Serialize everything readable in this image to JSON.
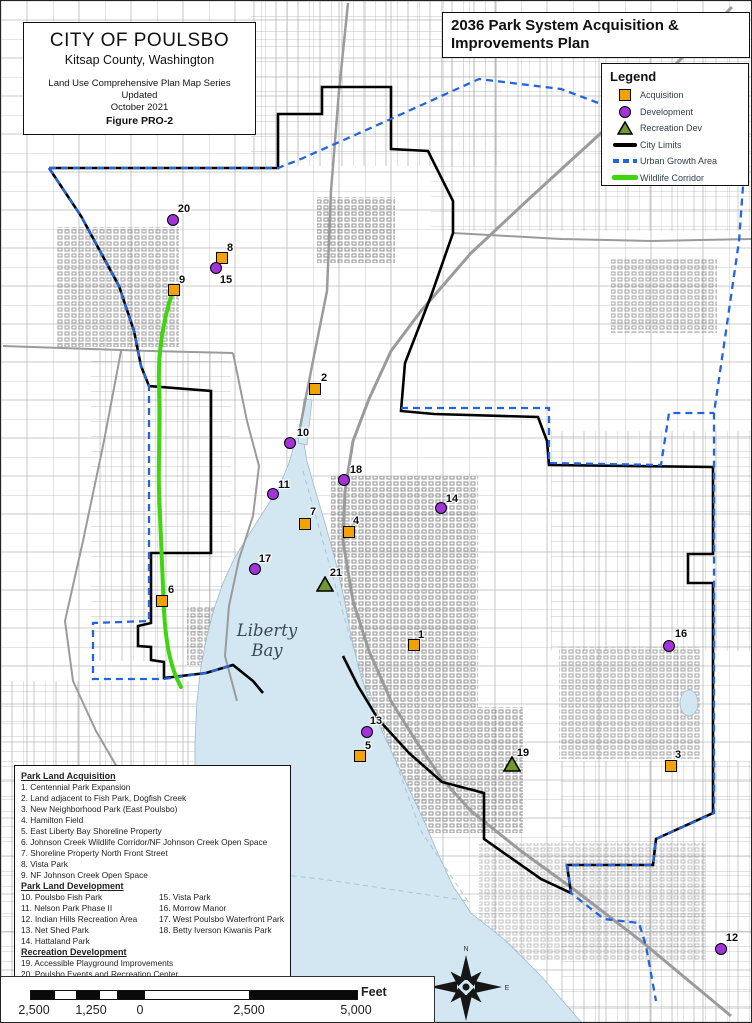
{
  "map_title_box": {
    "city": "CITY OF POULSBO",
    "county": "Kitsap County, Washington",
    "series": "Land Use Comprehensive Plan Map Series",
    "updated": "Updated",
    "date": "October 2021",
    "figure": "Figure PRO-2"
  },
  "plan_title": "2036 Park System Acquisition & Improvements Plan",
  "legend": {
    "title": "Legend",
    "items": [
      {
        "label": "Acquisition",
        "symbol": "acquisition-square",
        "color": "#F3A204"
      },
      {
        "label": "Development",
        "symbol": "development-circle",
        "color": "#A233D6"
      },
      {
        "label": "Recreation Dev",
        "symbol": "recreation-triangle",
        "color": "#6F9A2D"
      },
      {
        "label": "City Limits",
        "symbol": "city-limits-line",
        "color": "#000000"
      },
      {
        "label": "Urban Growth Area",
        "symbol": "uga-dashed-line",
        "color": "#2465DE"
      },
      {
        "label": "Wildlife Corridor",
        "symbol": "wildlife-line",
        "color": "#3FD60F"
      }
    ]
  },
  "park_list": {
    "sections": [
      {
        "title": "Park Land Acquisition",
        "items": [
          "1.  Centennial Park Expansion",
          "2.  Land adjacent to Fish Park, Dogfish Creek",
          "3.  New Neighborhood Park (East Poulsbo)",
          "4.  Hamilton Field",
          "5.  East Liberty Bay Shoreline Property",
          "6.  Johnson Creek Wildlife Corridor/NF Johnson Creek Open Space",
          "7.  Shoreline Property North Front Street",
          "8.  Vista Park",
          "9.  NF Johnson Creek Open Space"
        ]
      },
      {
        "title": "Park Land Development",
        "columns": [
          [
            "10. Poulsbo Fish Park",
            "11. Nelson Park Phase II",
            "12. Indian Hills Recreation Area",
            "13. Net Shed Park",
            "14. Hattaland Park"
          ],
          [
            "15. Vista Park",
            "16. Morrow Manor",
            "17. West Poulsbo Waterfront Park",
            "18. Betty Iverson Kiwanis Park"
          ]
        ]
      },
      {
        "title": "Recreation Development",
        "items": [
          "19. Accessible Playground Improvements",
          "20. Poulsbo Events and Recreation Center",
          "21. Poulsbo Recreation Center"
        ]
      }
    ]
  },
  "map_labels": {
    "water_body": "Liberty Bay"
  },
  "markers": [
    {
      "n": "1",
      "type": "acquisition",
      "x": 413,
      "y": 644,
      "dx": 7,
      "dy": -10
    },
    {
      "n": "2",
      "type": "acquisition",
      "x": 314,
      "y": 388,
      "dx": 9,
      "dy": -11
    },
    {
      "n": "3",
      "type": "acquisition",
      "x": 670,
      "y": 765,
      "dx": 7,
      "dy": -11
    },
    {
      "n": "4",
      "type": "acquisition",
      "x": 348,
      "y": 531,
      "dx": 7,
      "dy": -11
    },
    {
      "n": "5",
      "type": "acquisition",
      "x": 359,
      "y": 755,
      "dx": 8,
      "dy": -10
    },
    {
      "n": "6",
      "type": "acquisition",
      "x": 161,
      "y": 600,
      "dx": 9,
      "dy": -11
    },
    {
      "n": "7",
      "type": "acquisition",
      "x": 304,
      "y": 523,
      "dx": 8,
      "dy": -12
    },
    {
      "n": "8",
      "type": "acquisition",
      "x": 221,
      "y": 257,
      "dx": 8,
      "dy": -10
    },
    {
      "n": "9",
      "type": "acquisition",
      "x": 173,
      "y": 289,
      "dx": 8,
      "dy": -10
    },
    {
      "n": "10",
      "type": "development",
      "x": 289,
      "y": 442,
      "dx": 13,
      "dy": -10
    },
    {
      "n": "11",
      "type": "development",
      "x": 272,
      "y": 493,
      "dx": 11,
      "dy": -9
    },
    {
      "n": "12",
      "type": "development",
      "x": 720,
      "y": 948,
      "dx": 11,
      "dy": -11
    },
    {
      "n": "13",
      "type": "development",
      "x": 366,
      "y": 731,
      "dx": 9,
      "dy": -11
    },
    {
      "n": "14",
      "type": "development",
      "x": 440,
      "y": 507,
      "dx": 11,
      "dy": -9
    },
    {
      "n": "15",
      "type": "development",
      "x": 215,
      "y": 267,
      "dx": 10,
      "dy": 12
    },
    {
      "n": "16",
      "type": "development",
      "x": 668,
      "y": 645,
      "dx": 12,
      "dy": -12
    },
    {
      "n": "17",
      "type": "development",
      "x": 254,
      "y": 568,
      "dx": 10,
      "dy": -10
    },
    {
      "n": "18",
      "type": "development",
      "x": 343,
      "y": 479,
      "dx": 12,
      "dy": -10
    },
    {
      "n": "19",
      "type": "recreation",
      "x": 511,
      "y": 763,
      "dx": 11,
      "dy": -11
    },
    {
      "n": "20",
      "type": "development",
      "x": 172,
      "y": 219,
      "dx": 11,
      "dy": -11
    },
    {
      "n": "21",
      "type": "recreation",
      "x": 324,
      "y": 583,
      "dx": 11,
      "dy": -11
    }
  ],
  "scale_bar": {
    "labels": [
      "2,500",
      "1,250",
      "0",
      "2,500",
      "5,000"
    ],
    "unit": "Feet"
  },
  "compass": {
    "n": "N",
    "e": "E",
    "s": "S",
    "w": "W"
  },
  "colors": {
    "water": "#d3e7f3",
    "acquisition": "#F3A204",
    "development": "#A233D6",
    "recreation_dev": "#6F9A2D",
    "city_limits": "#000000",
    "urban_growth_area": "#2465DE",
    "wildlife_corridor": "#3FD60F"
  }
}
